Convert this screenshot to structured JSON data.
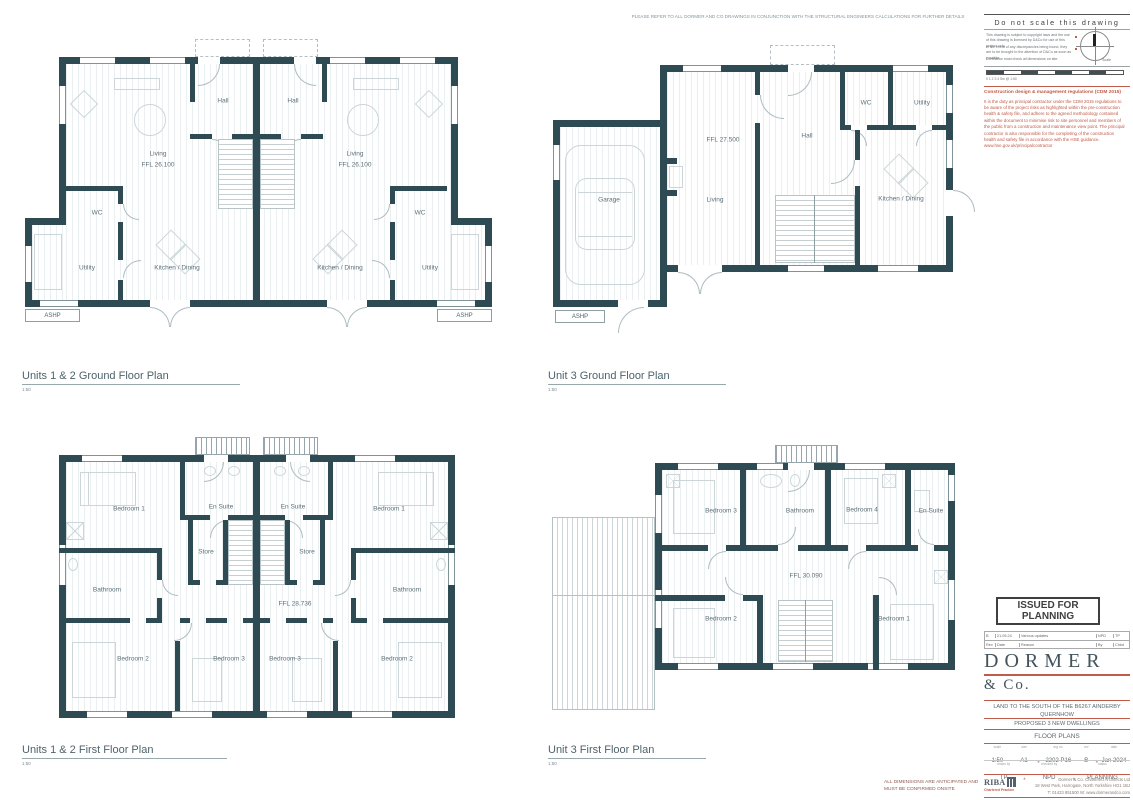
{
  "header_note": "PLEASE REFER TO ALL DORMER AND CO DRAWINGS IN CONJUNCTION WITH THE STRUCTURAL ENGINEERS CALCULATIONS FOR FURTHER DETAILS",
  "do_not_scale": {
    "title": "Do not scale this drawing",
    "note1": "This drawing is subject to copyright laws and the use of this drawing is licensed by D&Co for use of this project only.",
    "note2": "In the event of any discrepancies being found, they are to be brought to the attention of D&Co as soon as possible.",
    "note3": "Contractor must check all dimensions on site.",
    "scale_word": "Scale",
    "scalebar_caption": "0   1   2   3   4   5m @ 1:50"
  },
  "cdm": {
    "title": "Construction design & management regulations (CDM 2015)",
    "body": "It is the duty as principal contractor under the CDM 2015 regulations to be aware of the project risks as highlighted within the pre-construction health & safety file, and adhere to the agreed methodology contained within the document to minimise risk to site personnel and members of the public from a construction and maintenance view point. The principal contractor is also responsible for the completing of the construction health and safety file in accordance with the HSE guidance. www.hse.gov.uk/principalcontractor"
  },
  "plans": {
    "a": {
      "title": "Units 1 & 2 Ground Floor Plan",
      "scale": "1:50",
      "rooms": {
        "hall_l": "Hall",
        "hall_r": "Hall",
        "living_l": "Living",
        "ffl_l": "FFL 26.100",
        "living_r": "Living",
        "ffl_r": "FFL 26.100",
        "wc_l": "WC",
        "wc_r": "WC",
        "utility_l": "Utility",
        "utility_r": "Utility",
        "kitchen_l": "Kitchen / Dining",
        "kitchen_r": "Kitchen / Dining",
        "ashp_l": "ASHP",
        "ashp_r": "ASHP"
      }
    },
    "b": {
      "title": "Unit 3 Ground Floor Plan",
      "scale": "1:50",
      "rooms": {
        "garage": "Garage",
        "living": "Living",
        "ffl": "FFL 27.500",
        "hall": "Hall",
        "wc": "WC",
        "utility": "Utility",
        "kitchen": "Kitchen / Dining",
        "ashp": "ASHP"
      }
    },
    "c": {
      "title": "Units 1 & 2 First Floor Plan",
      "scale": "1:50",
      "rooms": {
        "bed1_l": "Bedroom 1",
        "ensuite_l": "En Suite",
        "ensuite_r": "En Suite",
        "bed1_r": "Bedroom 1",
        "store_l": "Store",
        "store_r": "Store",
        "bath_l": "Bathroom",
        "bath_r": "Bathroom",
        "ffl": "FFL 28.736",
        "bed2_l": "Bedroom 2",
        "bed3_l": "Bedroom 3",
        "bed3_r": "Bedroom 3",
        "bed2_r": "Bedroom 2"
      }
    },
    "d": {
      "title": "Unit 3 First Floor Plan",
      "scale": "1:50",
      "rooms": {
        "bed3": "Bedroom 3",
        "bath": "Bathroom",
        "bed4": "Bedroom 4",
        "ensuite": "En Suite",
        "ffl": "FFL 30.090",
        "bed2": "Bedroom 2",
        "bed1": "Bedroom 1"
      }
    }
  },
  "issued_for": "ISSUED FOR PLANNING",
  "revision": {
    "row": {
      "rev": "B",
      "date": "21.05.24",
      "reason": "Various updates",
      "by": "NPD",
      "chkd": "TP"
    },
    "head": {
      "rev": "Rev",
      "date": "Date",
      "reason": "Reason",
      "by": "By",
      "chkd": "Chkd"
    }
  },
  "logo": {
    "line1": "DORMER",
    "line2": "& Co."
  },
  "titleblock": {
    "project": "LAND TO THE SOUTH OF THE B6267 AINDERBY QUERNHOW",
    "proposal": "PROPOSED 3 NEW DWELLINGS",
    "drawing_title": "FLOOR PLANS",
    "scale_label": "scale",
    "scale": "1:50",
    "size_label": "size",
    "size": "A1",
    "drg_label": "drg no.",
    "drg": "2202 P16",
    "rev_label": "rev",
    "rev": "B",
    "date_label": "date",
    "date": "Jan 2024",
    "drawn_label": "drawn by",
    "drawn": "TP",
    "checked_label": "checked by",
    "checked": "NPD",
    "status_label": "status",
    "status": "PLANNING",
    "sep": "*",
    "riba": "RIBA",
    "riba_sub": "Chartered Practice",
    "firm": "Dormer & Co. Chartered Architects Ltd",
    "address": "18 West Park, Harrogate, North Yorkshire  HG1 1BJ",
    "contact": "T: 01423 851500   W: www.dormerandco.com"
  },
  "footer_warning": "ALL DIMENSIONS ARE ANTICIPATED AND MUST BE CONFIRMED ONSITE"
}
